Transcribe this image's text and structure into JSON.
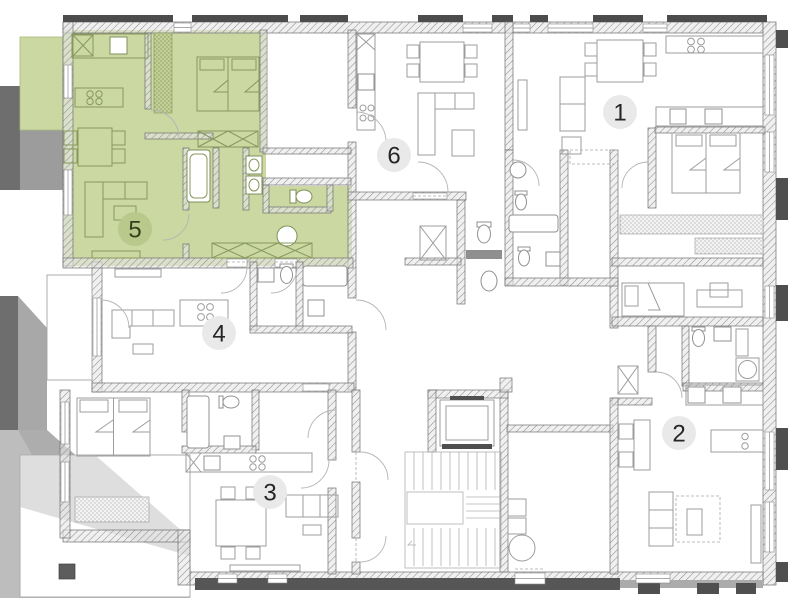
{
  "app": {
    "type": "building-floor-plan",
    "canvas": {
      "width": 800,
      "height": 600
    },
    "highlighted_unit": "5"
  },
  "palette": {
    "background": "#ffffff",
    "highlight_fill": "#cbd8a1",
    "highlight_stroke": "#a9b87d",
    "badge_fill": "#e9e9e9",
    "badge_text": "#262626",
    "highlight_badge_fill": "#b9c98c",
    "highlight_badge_text": "#33401d",
    "wall_fill": "#e3e3e3",
    "wall_hatch_line": "#8f8f8f",
    "shadow_dark": "#6e6e6e",
    "shadow_mid": "#a8a8a8",
    "shadow_light": "#c2c2c2",
    "furniture_stroke": "#9d9d9d",
    "furniture_stroke_highlight": "#88975f"
  },
  "units": [
    {
      "id": "1",
      "label": "1",
      "highlighted": false
    },
    {
      "id": "2",
      "label": "2",
      "highlighted": false
    },
    {
      "id": "3",
      "label": "3",
      "highlighted": false
    },
    {
      "id": "4",
      "label": "4",
      "highlighted": false
    },
    {
      "id": "5",
      "label": "5",
      "highlighted": true
    },
    {
      "id": "6",
      "label": "6",
      "highlighted": false
    }
  ]
}
